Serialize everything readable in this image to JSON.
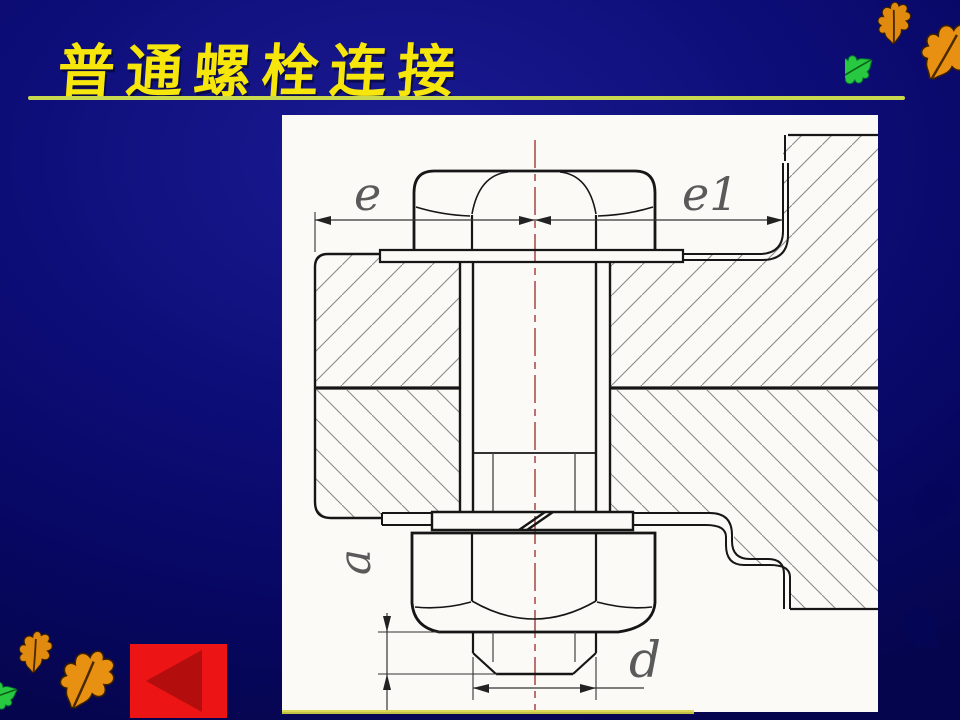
{
  "slide": {
    "title": "普通螺栓连接",
    "colors": {
      "background": "#0d0d78",
      "title_text": "#f6e60c",
      "underline": "#c8d94f",
      "panel": "#fbfaf6",
      "back_button": "#ec1414",
      "back_button_arrow": "#b30d0d",
      "centerline": "#a03838",
      "leaf_orange": "#e08a10",
      "leaf_green": "#28c840"
    }
  },
  "drawing": {
    "kind": "bolted-joint-cross-section",
    "labels": {
      "e": "e",
      "e1": "e1",
      "a": "a",
      "d": "d"
    }
  },
  "decorations": {
    "top_right_leaves": [
      "orange-oak-leaf",
      "orange-oak-leaf",
      "green-oak-leaf"
    ],
    "bottom_left_leaves": [
      "orange-oak-leaf",
      "orange-oak-leaf",
      "green-oak-leaf"
    ]
  }
}
